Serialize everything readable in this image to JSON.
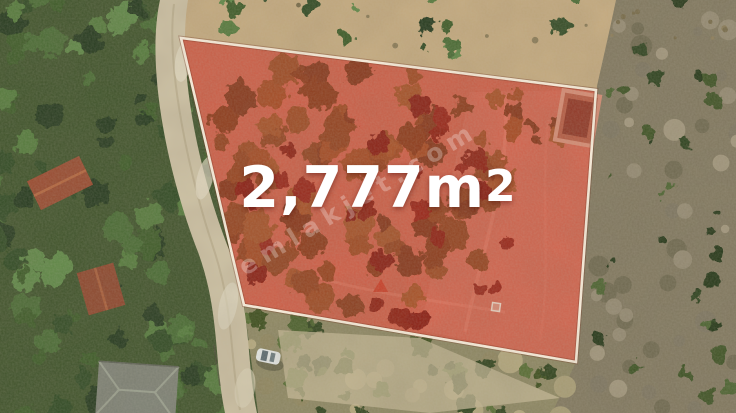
{
  "listing": {
    "area_value": "2,777m",
    "area_superscript": "2",
    "area_full": "2,777m²",
    "watermark": "emlakjet.com"
  },
  "colors": {
    "parcel_overlay_fill": "rgba(222,38,26,0.47)",
    "parcel_border": "#fff3e1",
    "area_text": "#ffffff",
    "watermark_text": "#ffffff"
  },
  "scene": {
    "description": "aerial drone photo of marked land parcel",
    "features": [
      "pine-forest",
      "gravel-road",
      "marked-parcel",
      "ruin-foundation",
      "parked-car",
      "tile-roof-houses",
      "rocky-scrubland"
    ]
  }
}
